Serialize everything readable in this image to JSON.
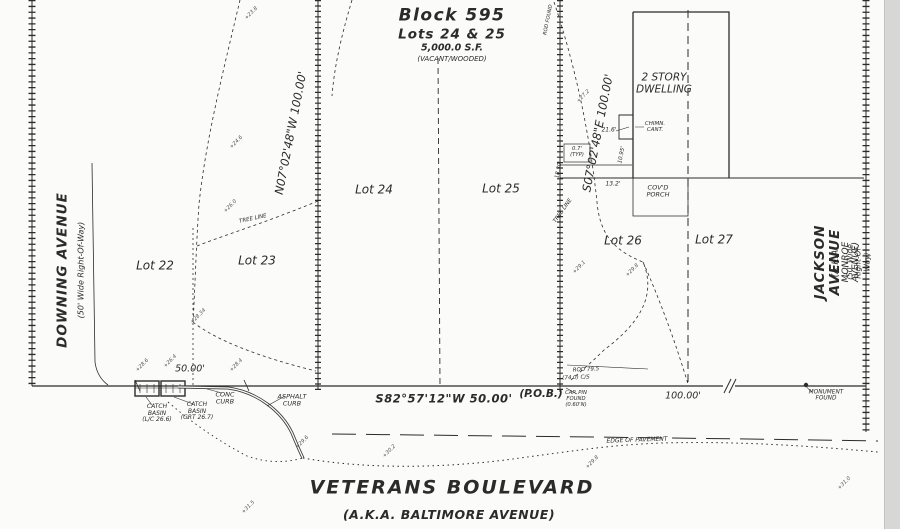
{
  "document_type": "survey plat",
  "title": {
    "block": "Block 595",
    "lots": "Lots 24 & 25",
    "area": "5,000.0 S.F.",
    "note": "(VACANT/WOODED)"
  },
  "streets": {
    "left": {
      "name": "DOWNING AVENUE",
      "sub": "(50' Wide Right-Of-Way)"
    },
    "right": {
      "name": "JACKSON AVENUE",
      "aka": "(A.K.A. MONROE AVENUE)",
      "sub": "(50' Wide Right-Of-Way)"
    },
    "bottom": {
      "name": "VETERANS BOULEVARD",
      "aka": "(A.K.A. BALTIMORE AVENUE)"
    }
  },
  "bearings": {
    "west_line": "N07°02'48\"W 100.00'",
    "east_line": "S07°02'48\"E 100.00'",
    "front_line": "S82°57'12\"W 50.00'"
  },
  "labels": [
    {
      "id": "block-title",
      "text": "Block 595",
      "x": 452,
      "y": 16,
      "s": 17,
      "w": 700,
      "ls": 1.5
    },
    {
      "id": "block-lots",
      "text": "Lots 24 & 25",
      "x": 452,
      "y": 35,
      "s": 13.5,
      "w": 700,
      "ls": 1
    },
    {
      "id": "block-area",
      "text": "5,000.0 S.F.",
      "x": 452,
      "y": 49,
      "s": 9.5,
      "w": 600
    },
    {
      "id": "block-note",
      "text": "(VACANT/WOODED)",
      "x": 452,
      "y": 60,
      "s": 7
    },
    {
      "id": "street-downing",
      "text": "DOWNING AVENUE",
      "x": 63,
      "y": 270,
      "s": 13.5,
      "w": 700,
      "ls": 1,
      "r": -90
    },
    {
      "id": "street-downing-sub",
      "text": "(50' Wide Right-Of-Way)",
      "x": 82,
      "y": 270,
      "s": 8,
      "r": -90
    },
    {
      "id": "street-jackson",
      "text": "JACKSON AVENUE",
      "x": 828,
      "y": 262,
      "s": 13.5,
      "w": 700,
      "ls": 1,
      "r": -90
    },
    {
      "id": "street-jackson-aka",
      "text": "(A.K.A. MONROE AVENUE)",
      "x": 846,
      "y": 262,
      "s": 9,
      "r": -90
    },
    {
      "id": "street-jackson-sub",
      "text": "(50' Wide Right-Of-Way)",
      "x": 859,
      "y": 262,
      "s": 7.5,
      "r": -90
    },
    {
      "id": "street-veterans",
      "text": "VETERANS BOULEVARD",
      "x": 452,
      "y": 488,
      "s": 19,
      "w": 700,
      "ls": 2
    },
    {
      "id": "street-veterans-aka",
      "text": "(A.K.A. BALTIMORE AVENUE)",
      "x": 449,
      "y": 515,
      "s": 12.5,
      "w": 700,
      "ls": 0.5
    },
    {
      "id": "lot-22-label",
      "text": "Lot 22",
      "x": 155,
      "y": 266,
      "s": 12
    },
    {
      "id": "lot-23-label",
      "text": "Lot 23",
      "x": 257,
      "y": 261,
      "s": 12
    },
    {
      "id": "lot-24-label",
      "text": "Lot 24",
      "x": 374,
      "y": 190,
      "s": 12
    },
    {
      "id": "lot-25-label",
      "text": "Lot 25",
      "x": 501,
      "y": 189,
      "s": 12
    },
    {
      "id": "lot-26-label",
      "text": "Lot 26",
      "x": 623,
      "y": 241,
      "s": 12
    },
    {
      "id": "lot-27-label",
      "text": "Lot 27",
      "x": 714,
      "y": 240,
      "s": 12
    },
    {
      "id": "bearing-west-line",
      "text": "N07°02'48\"W 100.00'",
      "x": 291,
      "y": 133,
      "s": 11.5,
      "r": -79
    },
    {
      "id": "bearing-east-line",
      "text": "S07°02'48\"E 100.00'",
      "x": 598,
      "y": 133,
      "s": 11.5,
      "r": -79
    },
    {
      "id": "bearing-front-line",
      "text": "S82°57'12\"W 50.00'",
      "x": 444,
      "y": 399,
      "s": 11.5,
      "w": 600,
      "ls": 0.5
    },
    {
      "id": "pob-label",
      "text": "(P.O.B.)",
      "x": 541,
      "y": 395,
      "s": 10.5,
      "w": 600
    },
    {
      "id": "dim-50ft",
      "text": "50.00'",
      "x": 190,
      "y": 370,
      "s": 9.5
    },
    {
      "id": "dim-100ft",
      "text": "100.00'",
      "x": 683,
      "y": 397,
      "s": 9.5
    },
    {
      "id": "monument-found",
      "text": "MONUMENT\nFOUND",
      "x": 826,
      "y": 396,
      "s": 5.8
    },
    {
      "id": "rod-dim",
      "text": "ROD  79.5",
      "x": 586,
      "y": 370,
      "s": 5.5,
      "r": -3
    },
    {
      "id": "cs-dim",
      "text": "(74.0) C/S",
      "x": 576,
      "y": 378,
      "s": 5.5,
      "r": -2
    },
    {
      "id": "cap-pin-found",
      "text": "CAP. PIN\nFOUND\n(0.60'N)",
      "x": 576,
      "y": 400,
      "s": 5.3
    },
    {
      "id": "dwelling-label",
      "text": "2 STORY\nDWELLING",
      "x": 664,
      "y": 84,
      "s": 10.5
    },
    {
      "id": "chimney-cant",
      "text": "CHIMN.\nCANT.",
      "x": 655,
      "y": 127,
      "s": 5.5
    },
    {
      "id": "dim-21-6",
      "text": "21.6'",
      "x": 609,
      "y": 131,
      "s": 6
    },
    {
      "id": "dim-typ",
      "text": "0.7'\n(TYP)",
      "x": 577,
      "y": 153,
      "s": 5.3
    },
    {
      "id": "dim-18-30",
      "text": "18.30'",
      "x": 559,
      "y": 170,
      "s": 5.5,
      "r": -79
    },
    {
      "id": "dim-10-95",
      "text": "10.95'",
      "x": 622,
      "y": 155,
      "s": 5.5,
      "r": -79
    },
    {
      "id": "dim-13-2",
      "text": "13.2'",
      "x": 613,
      "y": 185,
      "s": 6
    },
    {
      "id": "porch-label",
      "text": "COV'D\nPORCH",
      "x": 658,
      "y": 192,
      "s": 6.5
    },
    {
      "id": "conc-curb-label",
      "text": "CONC\nCURB",
      "x": 225,
      "y": 399,
      "s": 6.5
    },
    {
      "id": "asphalt-curb-label",
      "text": "ASPHALT\nCURB",
      "x": 292,
      "y": 401,
      "s": 6.5
    },
    {
      "id": "catch-basin-1",
      "text": "CATCH\nBASIN\n(L/C 26.6)",
      "x": 157,
      "y": 414,
      "s": 6
    },
    {
      "id": "catch-basin-2",
      "text": "CATCH\nBASIN\n(GRT 26.7)",
      "x": 197,
      "y": 412,
      "s": 6
    },
    {
      "id": "edge-of-pavement",
      "text": "EDGE OF PAVEMENT",
      "x": 637,
      "y": 441,
      "s": 6,
      "r": -2
    },
    {
      "id": "tree-line-1",
      "text": "TREE LINE",
      "x": 253,
      "y": 219,
      "s": 5.5,
      "r": -12
    },
    {
      "id": "tree-line-2",
      "text": "TREE LINE",
      "x": 563,
      "y": 211,
      "s": 5.5,
      "r": -55
    },
    {
      "id": "rod-found",
      "text": "ROD FOUND",
      "x": 549,
      "y": 20,
      "s": 5,
      "r": -79
    }
  ],
  "spot_elevations": [
    {
      "text": "+23.8",
      "x": 252,
      "y": 14
    },
    {
      "text": "+24.6",
      "x": 237,
      "y": 143
    },
    {
      "text": "+26.0",
      "x": 231,
      "y": 207
    },
    {
      "text": "+28.34",
      "x": 199,
      "y": 317
    },
    {
      "text": "+28.6",
      "x": 143,
      "y": 366
    },
    {
      "text": "+26.4",
      "x": 171,
      "y": 362
    },
    {
      "text": "+28.4",
      "x": 237,
      "y": 366
    },
    {
      "text": "+27.2",
      "x": 584,
      "y": 97
    },
    {
      "text": "+29.1",
      "x": 580,
      "y": 268
    },
    {
      "text": "+29.8",
      "x": 633,
      "y": 271
    },
    {
      "text": "+29.6",
      "x": 303,
      "y": 443
    },
    {
      "text": "+30.2",
      "x": 390,
      "y": 452
    },
    {
      "text": "+29.8",
      "x": 593,
      "y": 463
    },
    {
      "text": "+31.0",
      "x": 845,
      "y": 484
    },
    {
      "text": "+31.5",
      "x": 249,
      "y": 508
    }
  ],
  "colors": {
    "ink": "#2b2b2b",
    "faint_ink": "#555555",
    "paper": "#fbfbfa",
    "scan_edge": "#d7d7d6"
  }
}
